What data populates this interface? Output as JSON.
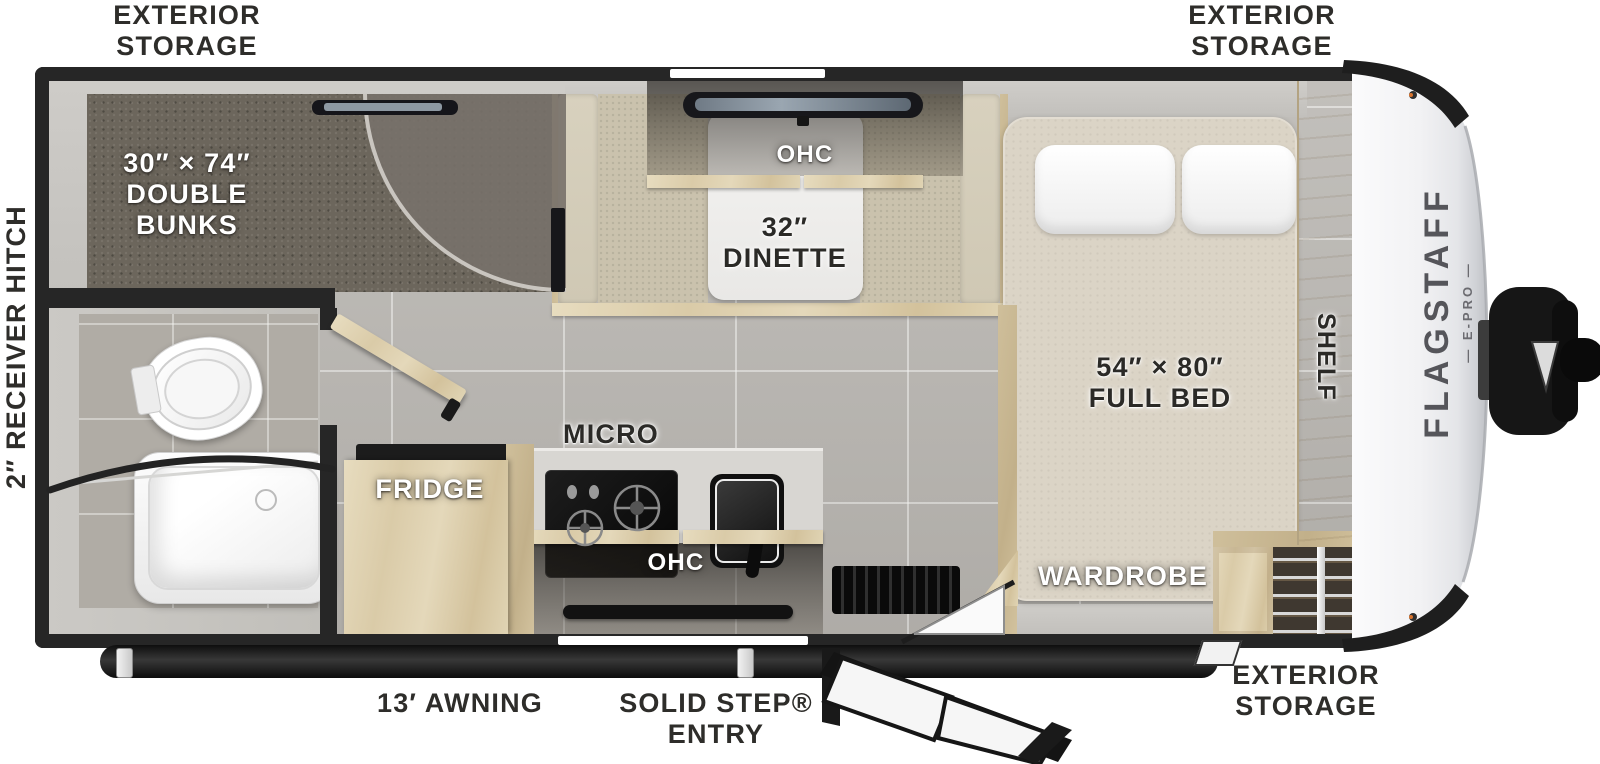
{
  "labels": {
    "exterior_storage_top_left": "EXTERIOR\nSTORAGE",
    "exterior_storage_top_right": "EXTERIOR\nSTORAGE",
    "exterior_storage_bottom_right": "EXTERIOR\nSTORAGE",
    "receiver_hitch": "2″ RECEIVER HITCH",
    "awning": "13′ AWNING",
    "solid_step_entry": "SOLID STEP®\nENTRY"
  },
  "rooms": {
    "double_bunks": "30″ × 74″\nDOUBLE\nBUNKS",
    "dinette_ohc": "OHC",
    "dinette": "32″\nDINETTE",
    "micro": "MICRO",
    "fridge": "FRIDGE",
    "kitchen_ohc": "OHC",
    "full_bed": "54″ × 80″\nFULL BED",
    "wardrobe": "WARDROBE",
    "shelf": "SHELF"
  },
  "brand": {
    "name": "FLAGSTAFF",
    "sub": "— E-PRO —"
  },
  "palette": {
    "wall": "#262626",
    "wood": "#ddcfac",
    "carpet": "#6c665c",
    "floor_tile": "#b8b5b0",
    "fabric": "#cac2ad",
    "mattress": "#dbd4c6",
    "front_cap": "#f0f0f1",
    "label_dark": "#2e2d2a",
    "label_light": "#ffffff"
  }
}
